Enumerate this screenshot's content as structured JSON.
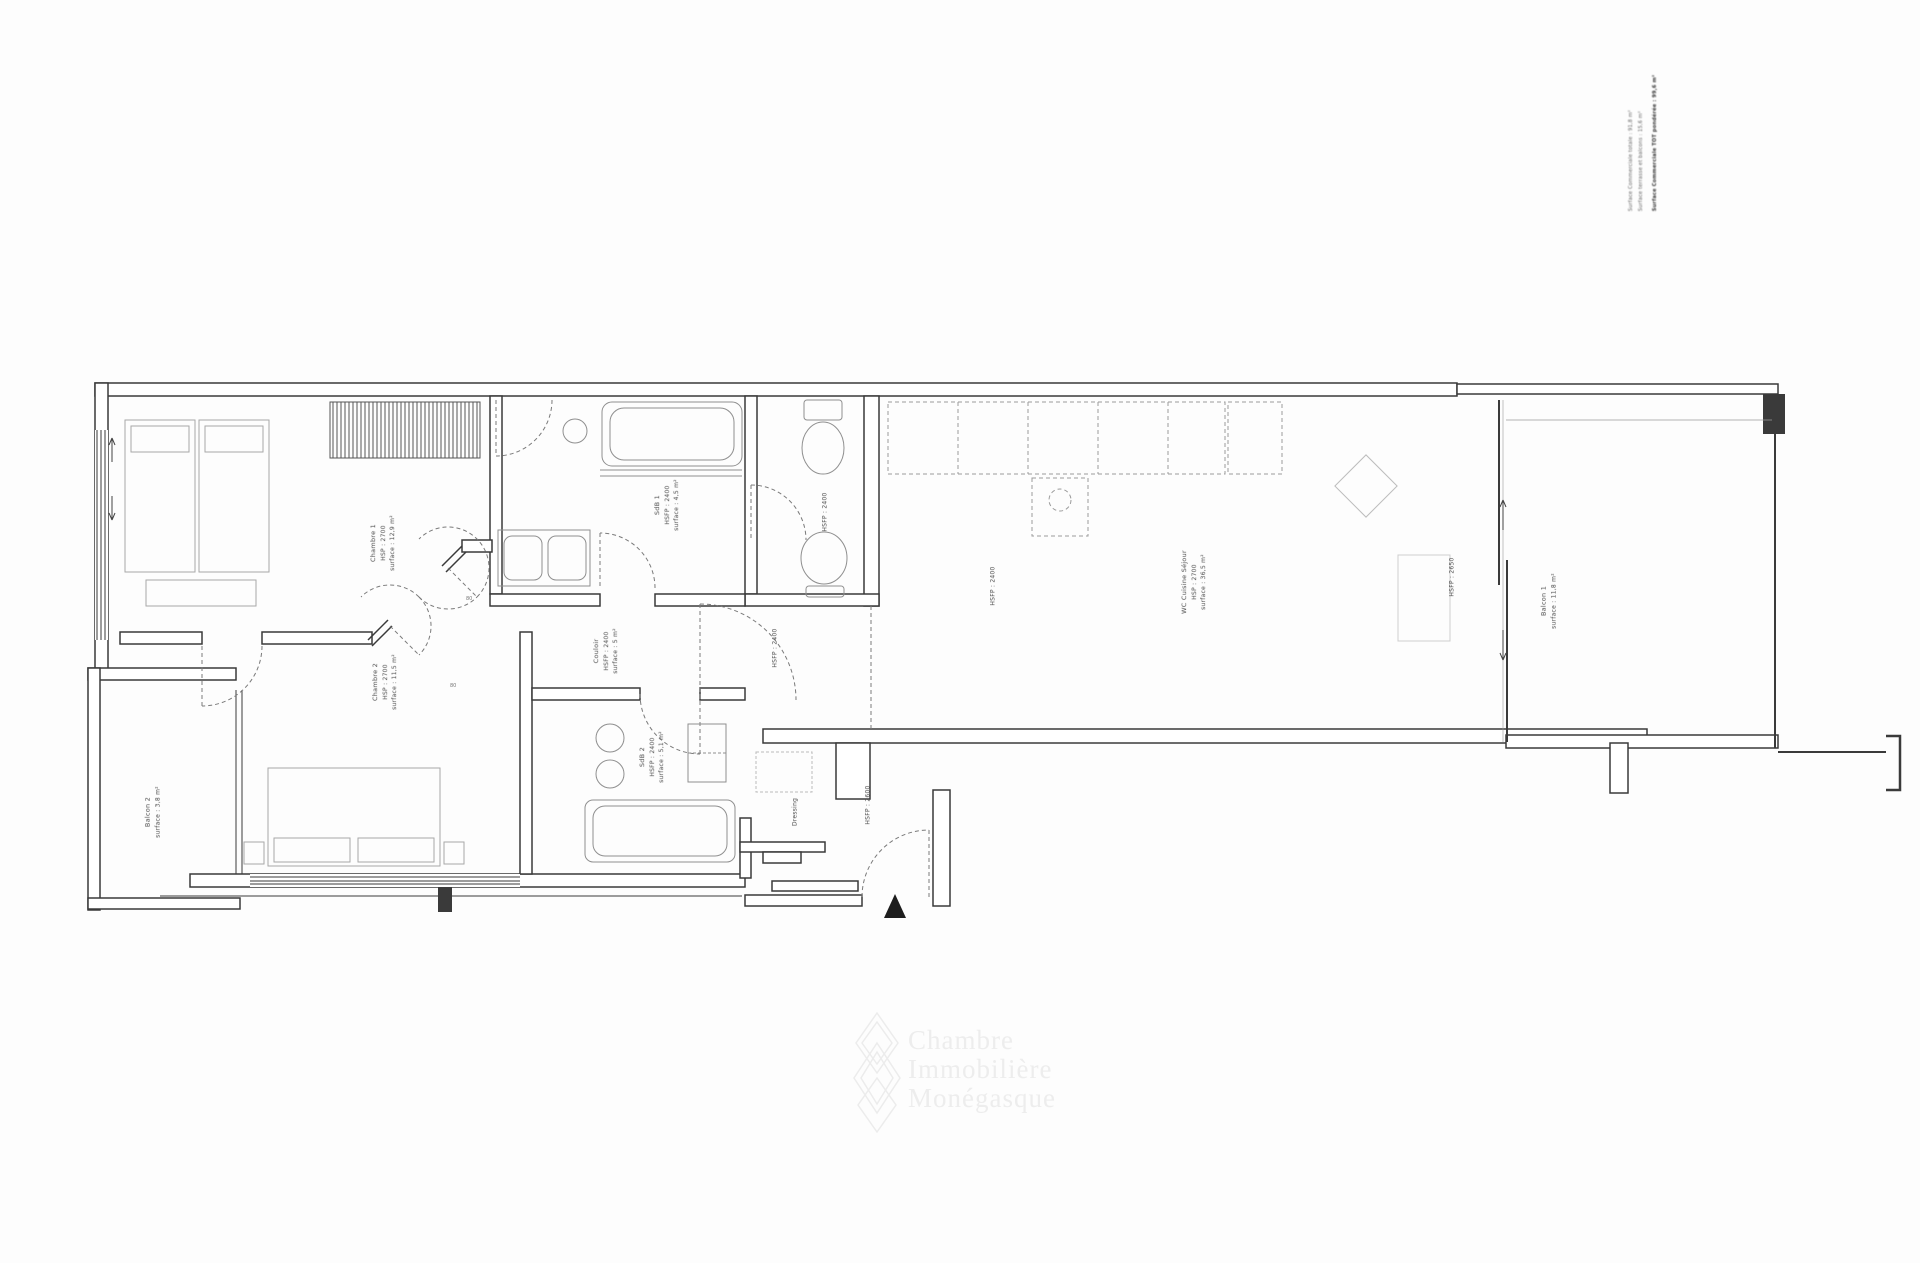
{
  "info_block": {
    "lines": [
      "Surface Commerciale totale : 91,8 m²",
      "Surface terrasse et balcons : 15,6 m²",
      "Surface Commerciale TOT pondérée : 99,6 m²"
    ]
  },
  "room_labels": {
    "chambre1": {
      "lines": [
        "Chambre 1",
        "HSP : 2700",
        "surface : 12,9 m²"
      ]
    },
    "sdb1": {
      "lines": [
        "SdB 1",
        "HSFP : 2400",
        "surface : 4,5 m²"
      ]
    },
    "wc": {
      "lines": [
        "HSFP : 2400"
      ]
    },
    "cuisine": {
      "lines": [
        "HSFP : 2400"
      ]
    },
    "sejour": {
      "lines": [
        "WC  Cuisine  Séjour",
        "HSP : 2700",
        "surface : 36,5 m²"
      ]
    },
    "baie": {
      "lines": [
        "HSFP : 2650"
      ]
    },
    "balcon1": {
      "lines": [
        "Balcon 1",
        "surface : 11,8 m²"
      ]
    },
    "chambre2": {
      "lines": [
        "Chambre 2",
        "HSP : 2700",
        "surface : 11,5 m²"
      ]
    },
    "couloir": {
      "lines": [
        "Couloir",
        "HSFP : 2400",
        "surface : 5 m²"
      ]
    },
    "entree": {
      "lines": [
        "HSFP : 2400"
      ]
    },
    "sdb2": {
      "lines": [
        "SdB 2",
        "HSFP : 2400",
        "surface : 5,1 m²"
      ]
    },
    "balcon2": {
      "lines": [
        "Balcon 2",
        "surface : 3,8 m²"
      ]
    },
    "dressing": {
      "lines": [
        "Dressing"
      ]
    },
    "hall": {
      "lines": [
        "HSFP : 2600"
      ]
    }
  },
  "door_marks": [
    "80",
    "80"
  ],
  "watermark": {
    "lines": [
      "Chambre",
      "Immobilière",
      "Monégasque"
    ]
  },
  "icons": {
    "entrance": "triangle-up-icon"
  },
  "colors": {
    "wall": "#3a3a3a",
    "label_text": "#4a4a4a",
    "watermark": "#ededed",
    "paper": "#fdfdfd"
  }
}
